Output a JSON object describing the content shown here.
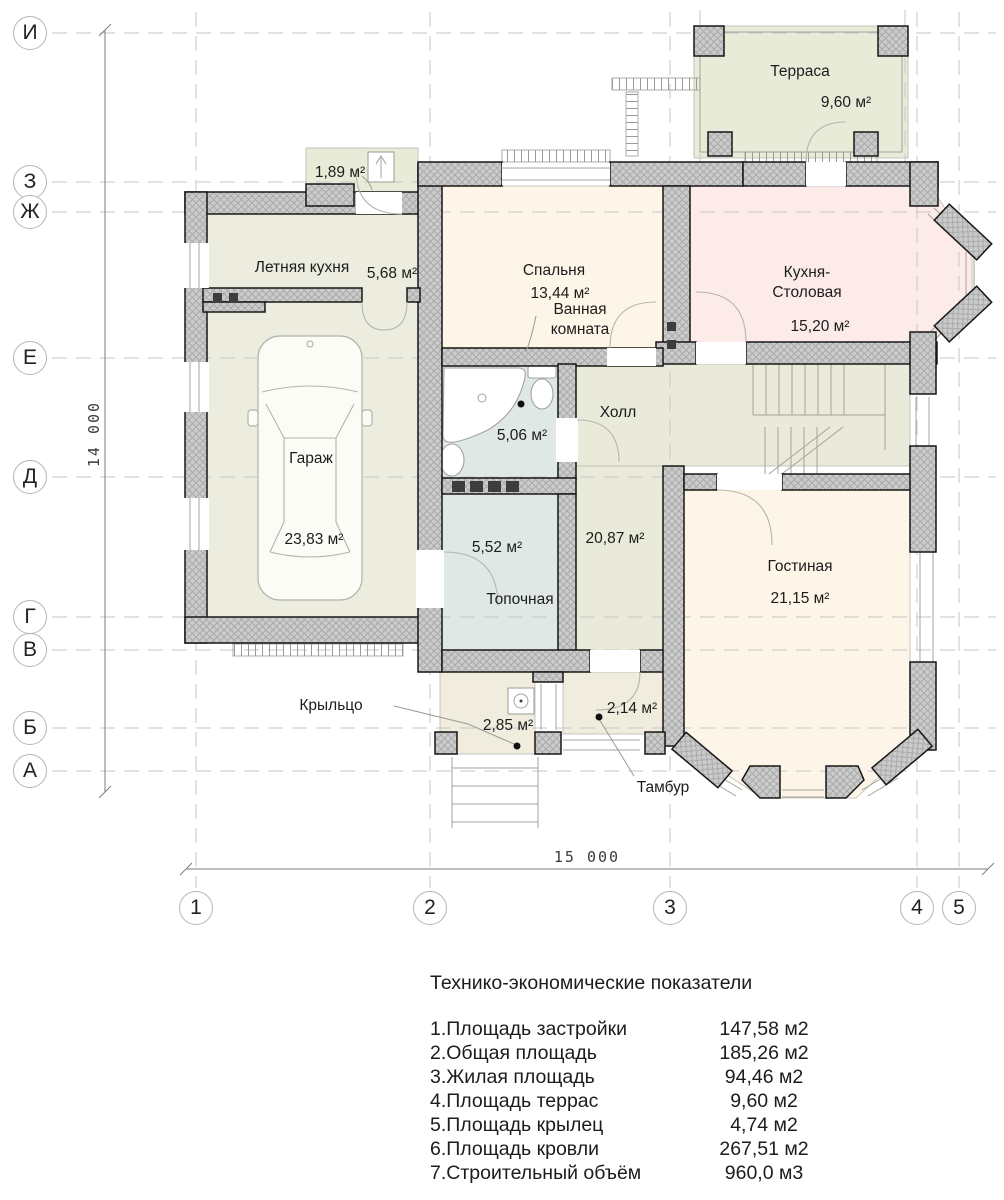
{
  "plan": {
    "axes": {
      "rows": [
        "И",
        "З",
        "Ж",
        "Е",
        "Д",
        "Г",
        "В",
        "Б",
        "А"
      ],
      "cols": [
        "1",
        "2",
        "3",
        "4",
        "5"
      ]
    },
    "dimensions": {
      "vertical": "14 000",
      "horizontal": "15 000"
    },
    "rooms": {
      "terrace": {
        "name": "Терраса",
        "area": "9,60 м²"
      },
      "top_porch": {
        "area": "1,89 м²"
      },
      "summer_kitchen": {
        "name": "Летняя кухня",
        "area": "5,68 м²"
      },
      "bedroom": {
        "name": "Спальня",
        "area": "13,44 м²"
      },
      "bathroom": {
        "name": "Ванная комната",
        "area": "5,06 м²"
      },
      "kitchen": {
        "name": "Кухня-Столовая",
        "area": "15,20 м²"
      },
      "garage": {
        "name": "Гараж",
        "area": "23,83 м²"
      },
      "hall": {
        "name": "Холл",
        "area": "20,87 м²"
      },
      "boiler": {
        "name": "Топочная",
        "area": "5,52 м²"
      },
      "living": {
        "name": "Гостиная",
        "area": "21,15 м²"
      },
      "tambour": {
        "name": "Тамбур",
        "area": "2,14 м²"
      },
      "porch": {
        "name": "Крыльцо",
        "area": "2,85 м²"
      }
    }
  },
  "table": {
    "title": "Технико-экономические показатели",
    "rows": [
      {
        "label": "1.Площадь застройки",
        "value": "147,58 м2"
      },
      {
        "label": "2.Общая площадь",
        "value": "185,26 м2"
      },
      {
        "label": "3.Жилая площадь",
        "value": "94,46 м2"
      },
      {
        "label": "4.Площадь террас",
        "value": "9,60 м2"
      },
      {
        "label": "5.Площадь крылец",
        "value": "4,74 м2"
      },
      {
        "label": "6.Площадь кровли",
        "value": "267,51 м2"
      },
      {
        "label": "7.Строительный объём",
        "value": "960,0 м3"
      }
    ]
  },
  "colors": {
    "wall-fill": "#cbcbcb",
    "room-cream": "#fdf6e8",
    "room-pink": "#fcebe8",
    "room-blue": "#dfe8e5",
    "room-green": "#ecedde",
    "room-hall": "#eaeada",
    "room-terrace": "#e9ebd9",
    "room-porch": "#f0eddf"
  }
}
